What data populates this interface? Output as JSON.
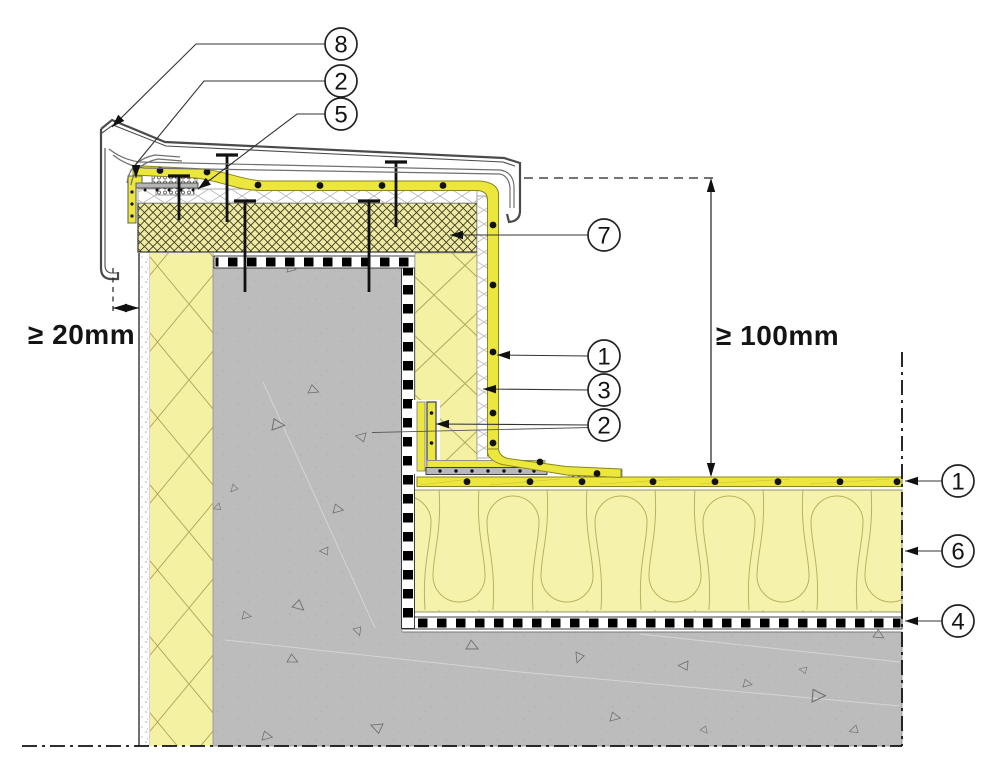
{
  "drawing": {
    "name": "parapet-flat-roof-construction-detail"
  },
  "dimensions": {
    "overhang": {
      "text": "≥ 20mm"
    },
    "upstand_height": {
      "text": "≥ 100mm"
    }
  },
  "callouts": [
    {
      "label": "8",
      "cx": 341,
      "cy": 44,
      "points": [
        [
          325,
          44
        ],
        [
          196,
          44
        ],
        [
          112,
          127
        ]
      ]
    },
    {
      "label": "2",
      "cx": 341,
      "cy": 81,
      "points": [
        [
          325,
          81
        ],
        [
          204,
          81
        ],
        [
          136,
          164
        ],
        [
          136,
          178
        ]
      ]
    },
    {
      "label": "5",
      "cx": 341,
      "cy": 114,
      "points": [
        [
          325,
          114
        ],
        [
          297,
          114
        ],
        [
          198,
          189
        ]
      ]
    },
    {
      "label": "7",
      "cx": 604,
      "cy": 235,
      "points": [
        [
          589,
          235
        ],
        [
          450,
          235
        ]
      ]
    },
    {
      "label": "1",
      "cx": 604,
      "cy": 356,
      "points": [
        [
          589,
          356
        ],
        [
          497,
          355
        ]
      ]
    },
    {
      "label": "3",
      "cx": 604,
      "cy": 390,
      "points": [
        [
          589,
          390
        ],
        [
          483,
          389
        ]
      ]
    },
    {
      "label": "2",
      "cx": 604,
      "cy": 425,
      "points": [
        [
          589,
          425
        ],
        [
          436,
          424
        ]
      ]
    },
    {
      "label": "1",
      "cx": 958,
      "cy": 481,
      "points": [
        [
          943,
          481
        ],
        [
          905,
          481
        ]
      ]
    },
    {
      "label": "6",
      "cx": 958,
      "cy": 551,
      "points": [
        [
          943,
          551
        ],
        [
          905,
          551
        ]
      ]
    },
    {
      "label": "4",
      "cx": 958,
      "cy": 621,
      "points": [
        [
          943,
          621
        ],
        [
          905,
          621
        ]
      ]
    }
  ],
  "colors": {
    "membrane_yellow": "#ece73c",
    "insulation_pale_yellow": "#f4f1a2",
    "mineral_wool_yellow": "#f5f2ac",
    "parapet_board_yellow": "#efeaa4",
    "concrete_gray": "#bcbcbc",
    "metal_gray": "#4a4a4a",
    "line_black": "#111111"
  }
}
